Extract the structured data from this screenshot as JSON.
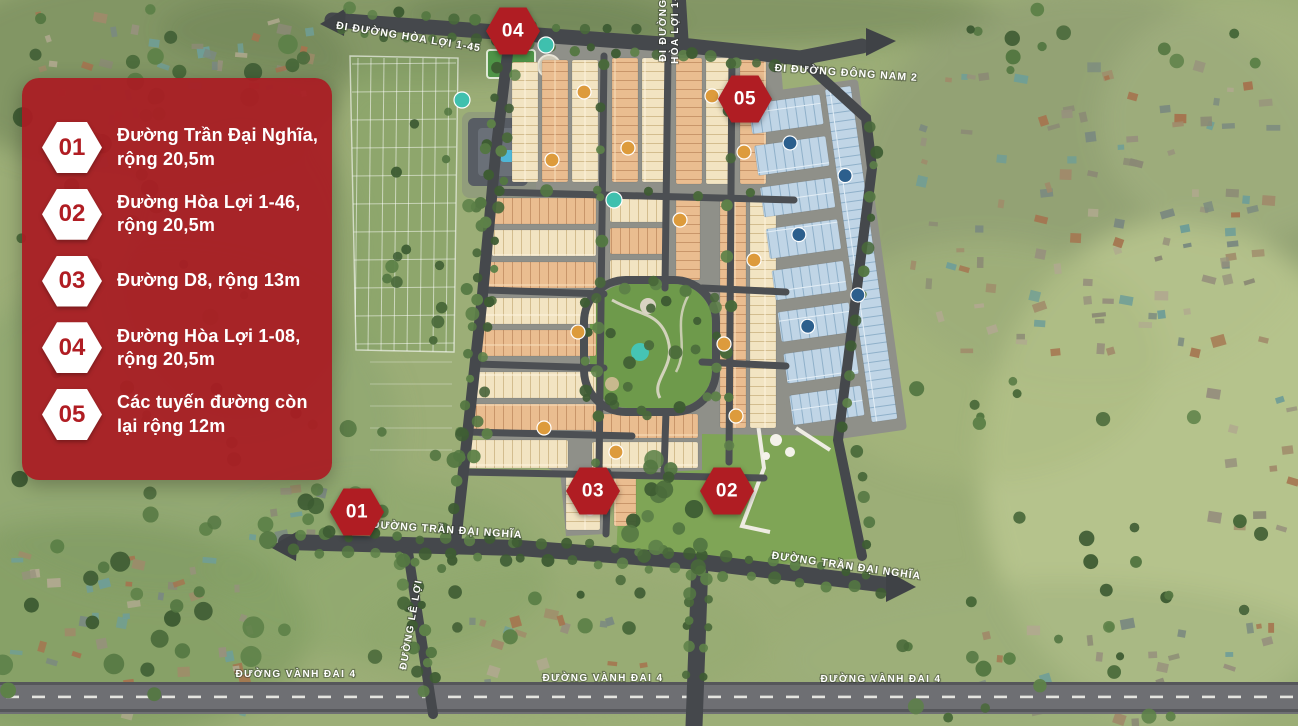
{
  "legend": {
    "items": [
      {
        "number": "01",
        "label": "Đường Trần Đại Nghĩa, rộng 20,5m"
      },
      {
        "number": "02",
        "label": "Đường Hòa Lợi 1-46, rộng 20,5m"
      },
      {
        "number": "03",
        "label": "Đường D8, rộng 13m"
      },
      {
        "number": "04",
        "label": "Đường Hòa Lợi 1-08, rộng 20,5m"
      },
      {
        "number": "05",
        "label": "Các tuyến đường còn lại rộng 12m"
      }
    ]
  },
  "map": {
    "markers": [
      {
        "number": "01"
      },
      {
        "number": "02"
      },
      {
        "number": "03"
      },
      {
        "number": "04"
      },
      {
        "number": "05"
      }
    ],
    "road_labels": {
      "hoa_loi_1_45": "ĐI ĐƯỜNG HÒA LỢI 1-45",
      "hoa_loi_north_line1": "ĐI ĐƯỜNG",
      "hoa_loi_north_line2": "HÒA LỢI 1-",
      "dong_nam_2": "ĐI ĐƯỜNG ĐÔNG NAM 2",
      "tran_dai_nghia": "ĐƯỜNG TRẦN ĐẠI NGHĨA",
      "le_loi": "ĐƯỜNG LÊ LỢI",
      "vanh_dai_4": "ĐƯỜNG VÀNH ĐAI 4"
    }
  },
  "colors": {
    "legend_red": "#a91e24",
    "marker_red": "#b01d23",
    "house_orange": "#eabd90",
    "house_cream": "#f2e4c2",
    "house_blue": "#c0d5e6",
    "road_gray": "#45484c",
    "park_green": "#6e9a4b",
    "label_white": "#ffffff"
  }
}
